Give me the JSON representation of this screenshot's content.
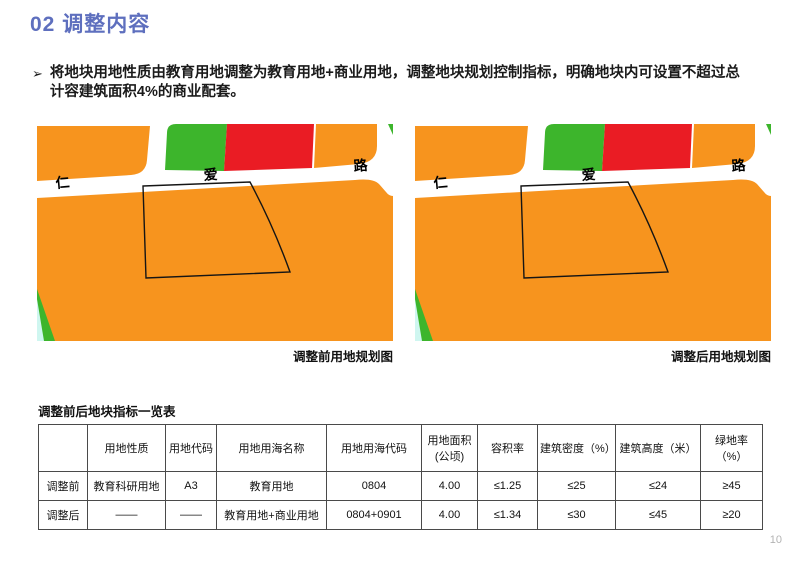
{
  "page": {
    "title": "02 调整内容",
    "title_color": "#5E6FBE",
    "page_number": "10"
  },
  "bullet": {
    "marker": "➢",
    "text": "将地块用地性质由教育用地调整为教育用地+商业用地，调整地块规划控制指标，明确地块内可设置不超过总计容建筑面积4%的商业配套。"
  },
  "maps": {
    "road_labels": {
      "left": "仁",
      "middle": "爱",
      "right": "路"
    },
    "before_caption": "调整前用地规划图",
    "after_caption": "调整后用地规划图",
    "colors": {
      "land_orange": "#F7941E",
      "park_green": "#3DB52C",
      "commercial_red": "#EA1C24",
      "water_cyan": "#CFF6F0",
      "parcel_outline": "#151515"
    }
  },
  "table": {
    "title": "调整前后地块指标一览表",
    "headers": [
      "",
      "用地性质",
      "用地代码",
      "用地用海名称",
      "用地用海代码",
      "用地面积\n(公顷)",
      "容积率",
      "建筑密度（%）",
      "建筑高度（米）",
      "绿地率（%）"
    ],
    "rows": [
      {
        "label": "调整前",
        "cells": [
          "教育科研用地",
          "A3",
          "教育用地",
          "0804",
          "4.00",
          "≤1.25",
          "≤25",
          "≤24",
          "≥45"
        ]
      },
      {
        "label": "调整后",
        "cells": [
          "——",
          "——",
          "教育用地+商业用地",
          "0804+0901",
          "4.00",
          "≤1.34",
          "≤30",
          "≤45",
          "≥20"
        ]
      }
    ]
  }
}
